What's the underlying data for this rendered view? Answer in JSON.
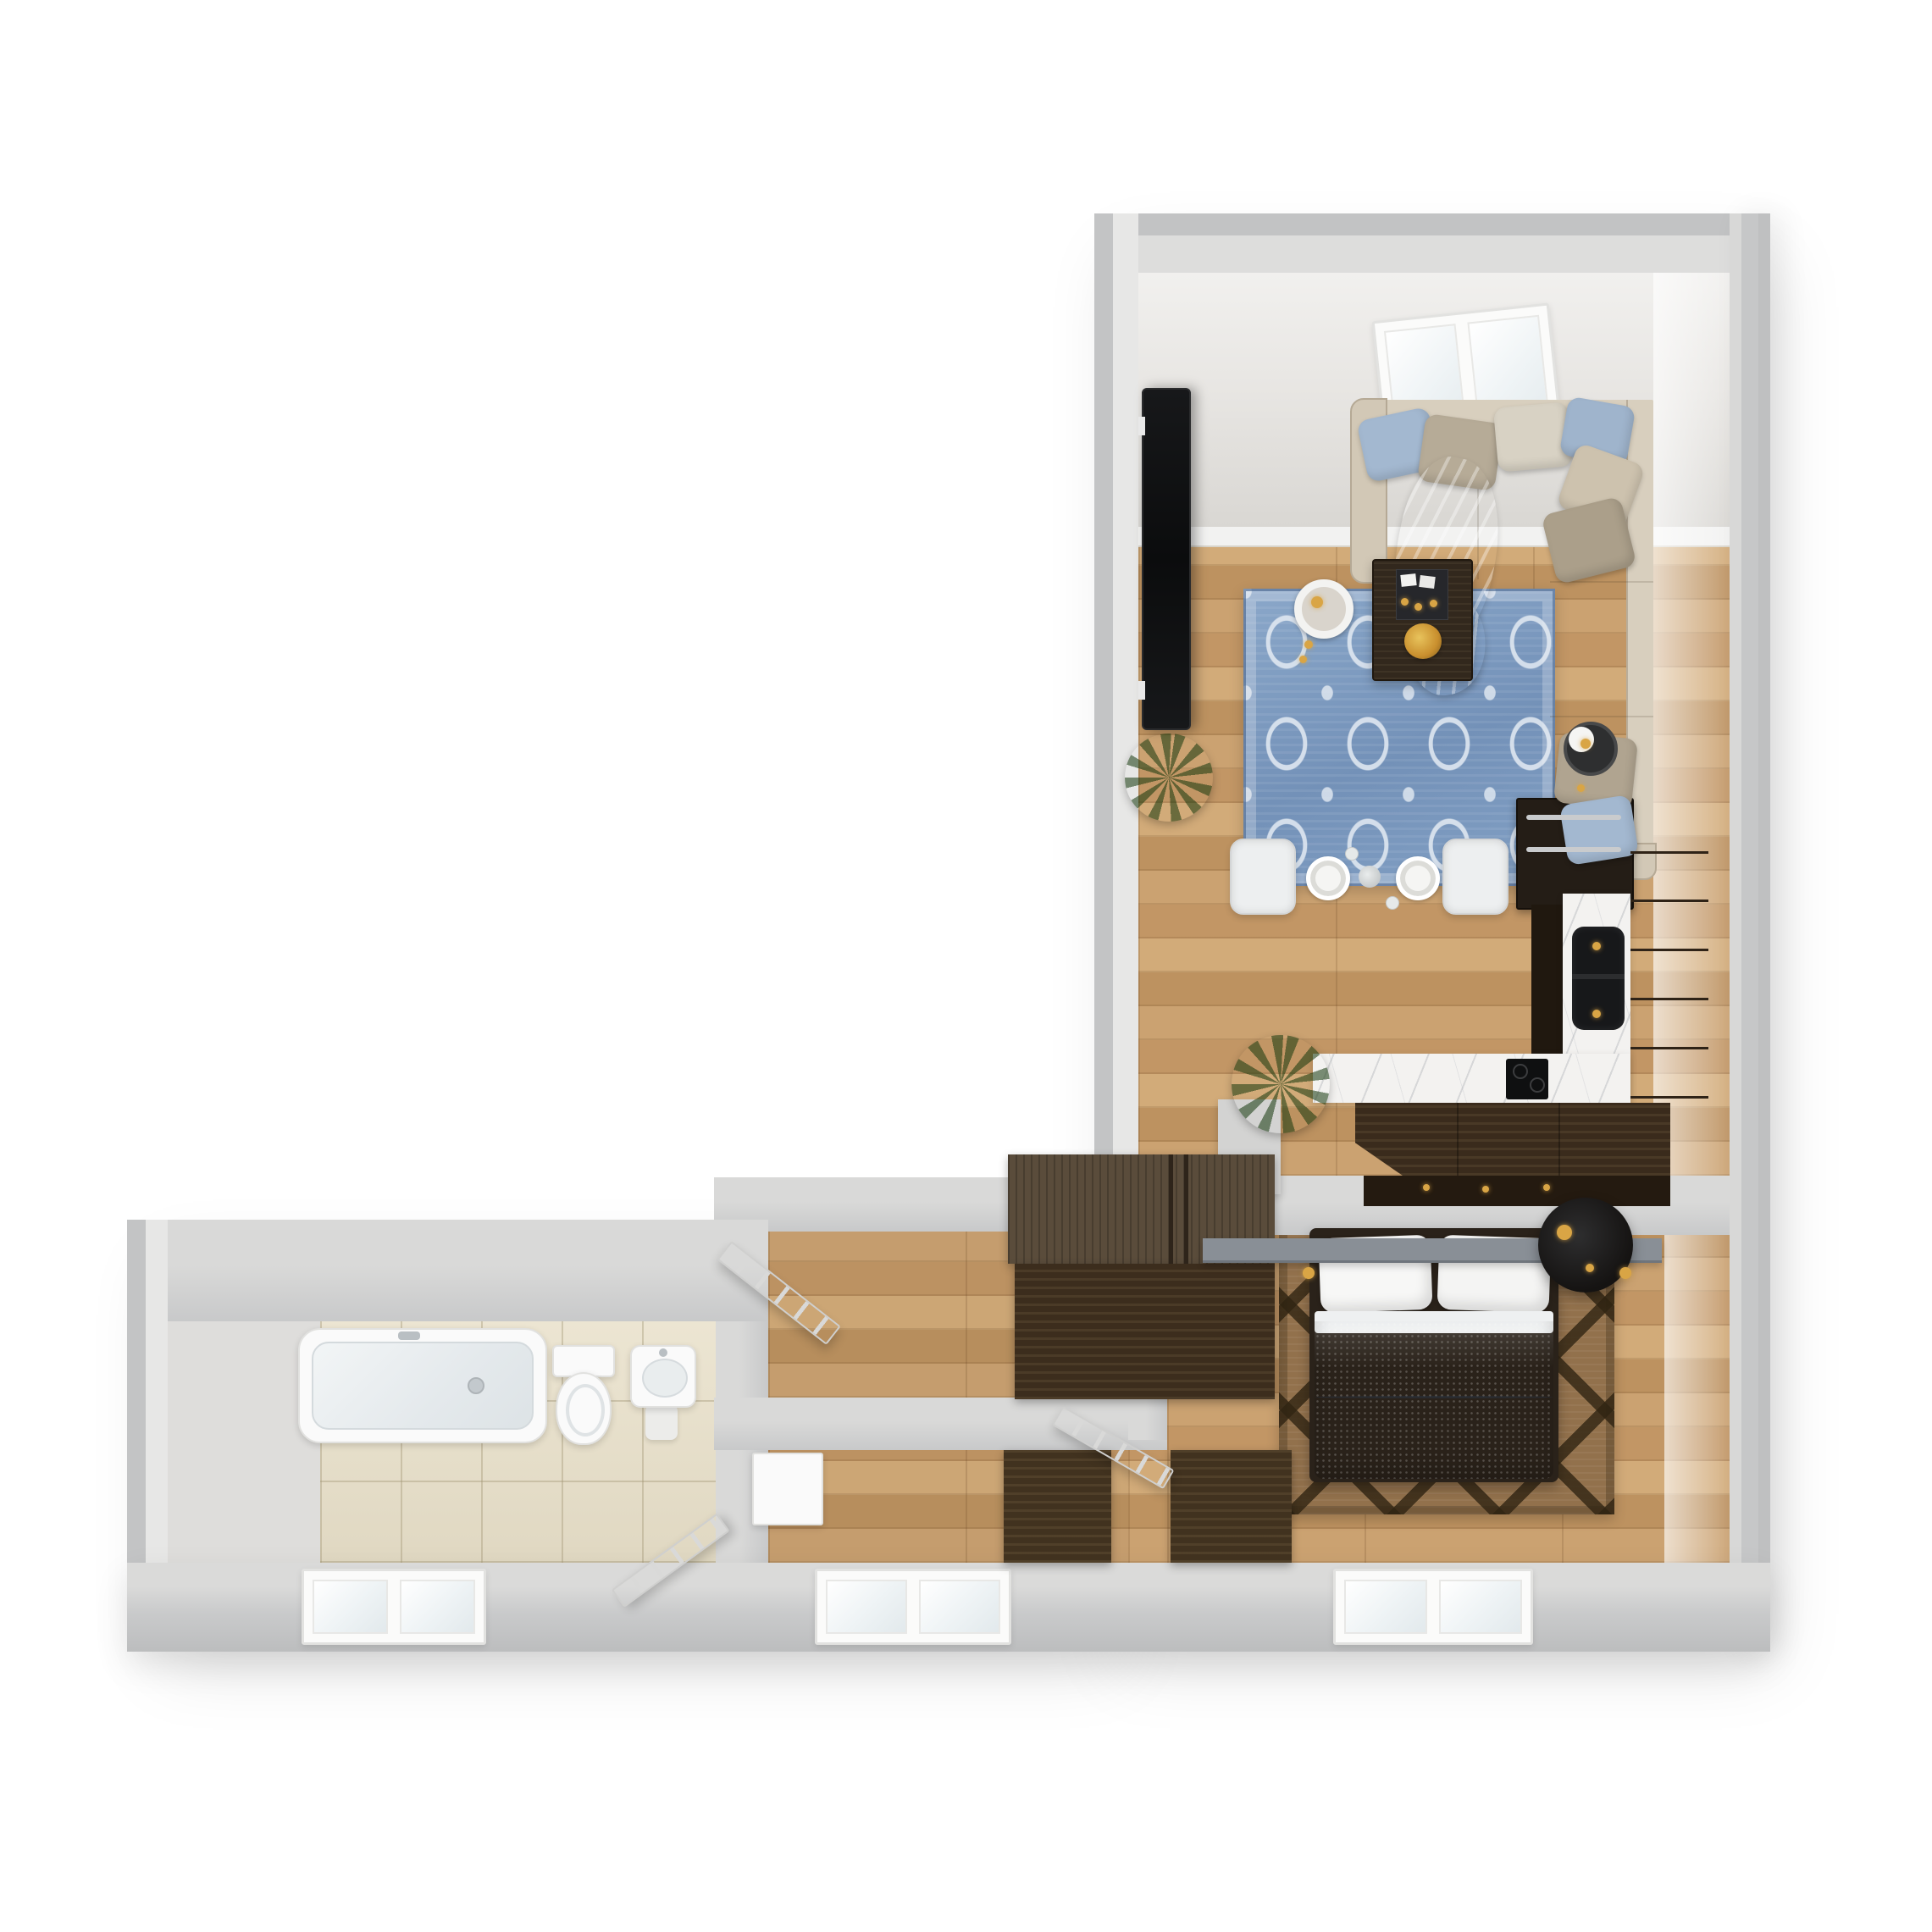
{
  "image": {
    "type": "3d-floor-plan-render",
    "view": "top-down",
    "background_color": "#ffffff"
  },
  "rooms": {
    "living_room": {
      "label": "Living room with beige L-shaped sectional sofa, blue ornamental rug, coffee table, TV and skylight"
    },
    "dining_area": {
      "label": "Dining area with dark wood table set for two and white chairs"
    },
    "kitchen": {
      "label": "Kitchen with dark wood cabinets, black range, marble counter, black sink and bar peninsula"
    },
    "hallway": {
      "label": "Hallway with large dark wardrobe and open entry door"
    },
    "second_room": {
      "label": "Second room with white cabinet, dark dresser and window"
    },
    "bedroom": {
      "label": "Bedroom with double bed, blue duvet, lattice rug, wall shelf and round bedside table"
    },
    "bathroom": {
      "label": "Bathroom with bathtub, toilet, washbasin, beige tile floor and window"
    }
  },
  "furniture_labels": {
    "sofa": "L-shaped beige sectional sofa with throw pillows and blanket",
    "coffee_table": "Dark wood coffee table with decor tray and yellow flowers",
    "tv": "Wall-mounted television",
    "side_table_a": "Side table with ring lamp",
    "side_table_b": "Side table with round lamp",
    "dining_table": "Dining table with two white place settings",
    "range": "Black range with steel handles",
    "sink": "Black double-bowl kitchen sink",
    "cooktop": "Black cooktop",
    "bar": "Dark wood bar peninsula",
    "wardrobe": "Large dark wood wardrobe",
    "bed": "Double bed with white pillows and blue duvet",
    "bedside_table": "Round black bedside table",
    "shelf": "Gray wall shelf",
    "dresser": "Dark wood dresser",
    "white_cabinet": "White cabinet",
    "bathtub": "Bathtub",
    "toilet": "Toilet",
    "washbasin": "Pedestal washbasin",
    "entry_door": "Open entry door",
    "bathroom_door": "Open bathroom door",
    "bedroom_door": "Open interior door",
    "skylight": "Ceiling skylight with two panes",
    "window": "Two-pane window"
  },
  "counts": {
    "skylight_panes": 2,
    "south_windows": 3,
    "interior_doors": 3,
    "throw_pillows": 8,
    "plants": 2
  },
  "palette": {
    "wall": "#c9cacb",
    "wall_face": "#e9eaea",
    "wood_floor": "#c49a68",
    "dark_wood": "#3c2d1d",
    "rug_blue": "#7f9cc0",
    "rug_brown": "#92714c",
    "sofa_beige": "#cbc0ae",
    "duvet_blue": "#7c98b9",
    "marble": "#f2f1ee",
    "tile_beige": "#e7e0cc",
    "glass": "#eff4f6",
    "accent_gold": "#d9a545",
    "plant_green": "#4a8528",
    "fixture_white": "#fafafa"
  }
}
